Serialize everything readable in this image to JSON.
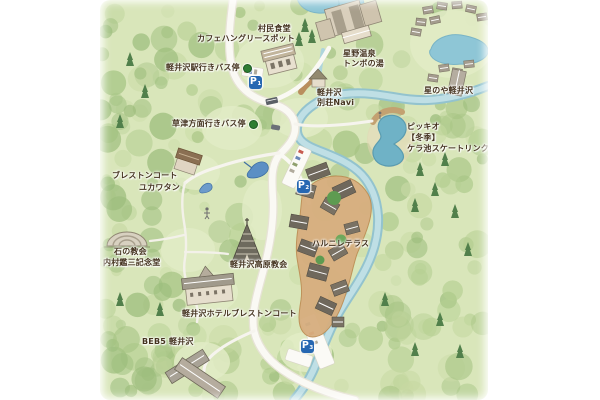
{
  "colors": {
    "map_bg": "#d9e6ba",
    "parking_blue": "#2667b2",
    "busstop_green": "#2e7d33",
    "river": "#aed5dc",
    "pond": "#6fb2c6",
    "terrace": "#d7ae7e",
    "label_text": "#44331f"
  },
  "labels": {
    "sonmin_shokudo": "村民食堂",
    "cafe_hungry_spot": "カフェハングリースポット",
    "hoshino_onsen_line1": "星野温泉",
    "hoshino_onsen_line2": "トンボの湯",
    "bus_karuizawa_station": "軽井沢駅行きバス停",
    "bus_kusatsu": "草津方面行きバス停",
    "besso_navi_line1": "軽井沢",
    "besso_navi_line2": "別荘Navi",
    "hoshinoya": "星のや軽井沢",
    "picchio_line1": "ピッキオ",
    "picchio_line2": "【冬季】",
    "picchio_line3": "ケラ池スケートリンク",
    "bleston_court_line1": "ブレストンコート",
    "bleston_court_line2": "ユカワタン",
    "harunire_terrace": "ハルニレテラス",
    "stone_church_line1": "石の教会",
    "stone_church_line2": "内村鑑三記念堂",
    "kogen_church": "軽井沢高原教会",
    "hotel_bleston_court": "軽井沢ホテルブレストンコート",
    "beb5": "BEB5 軽井沢"
  },
  "markers": {
    "p1": {
      "label": "P",
      "sub": "1"
    },
    "p2": {
      "label": "P",
      "sub": "2"
    },
    "p3": {
      "label": "P",
      "sub": "3"
    }
  }
}
